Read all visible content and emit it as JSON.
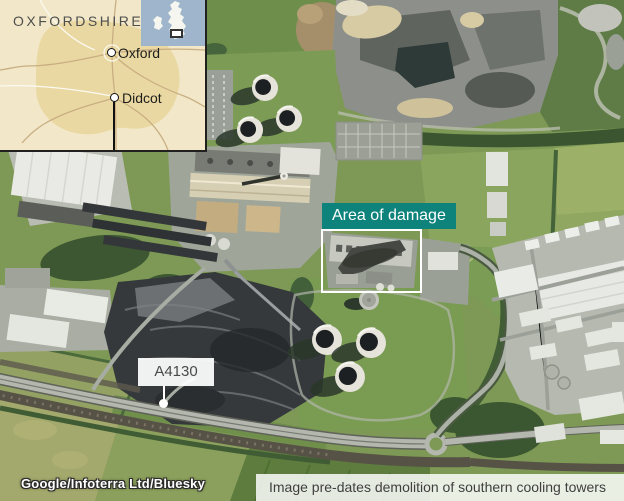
{
  "inset": {
    "region_label": "OXFORDSHIRE",
    "cities": [
      {
        "name": "Oxford"
      },
      {
        "name": "Didcot"
      }
    ],
    "colors": {
      "background": "#f2e8c9",
      "county_fill": "#ead8a2",
      "minimap_sea": "#9eb5cb",
      "minimap_land": "#f6f6f0"
    }
  },
  "annotations": {
    "damage": {
      "label": "Area of damage",
      "accent_color": "#0e837b"
    },
    "road": {
      "label": "A4130"
    }
  },
  "footer": {
    "attribution": "Google/Infoterra Ltd/Bluesky",
    "caption": "Image pre-dates demolition of southern cooling towers"
  }
}
